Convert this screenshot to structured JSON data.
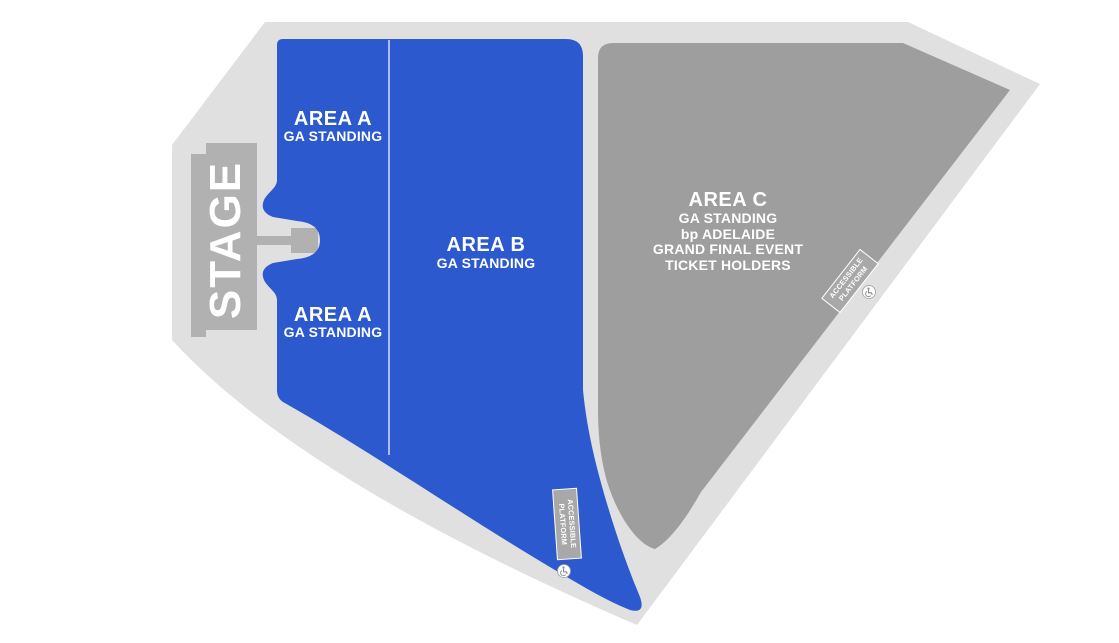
{
  "colors": {
    "ga_blue": "#2d59cf",
    "floor_gray": "#e0e0e0",
    "stage_gray": "#b1b1b1",
    "area_c_gray": "#9e9e9e",
    "platform_gray": "#a8a8a8",
    "label_white": "#ffffff"
  },
  "stage": {
    "label": "STAGE"
  },
  "areas": {
    "a_top": {
      "name": "AREA A",
      "type": "GA STANDING"
    },
    "a_bottom": {
      "name": "AREA A",
      "type": "GA STANDING"
    },
    "b": {
      "name": "AREA B",
      "type": "GA STANDING"
    },
    "c": {
      "name": "AREA C",
      "line1": "GA STANDING",
      "line2": "bp ADELAIDE",
      "line3": "GRAND FINAL EVENT",
      "line4": "TICKET HOLDERS"
    }
  },
  "platforms": {
    "right": {
      "line1": "ACCESSIBLE",
      "line2": "PLATFORM"
    },
    "bottom": {
      "line1": "ACCESSIBLE",
      "line2": "PLATFORM"
    }
  }
}
